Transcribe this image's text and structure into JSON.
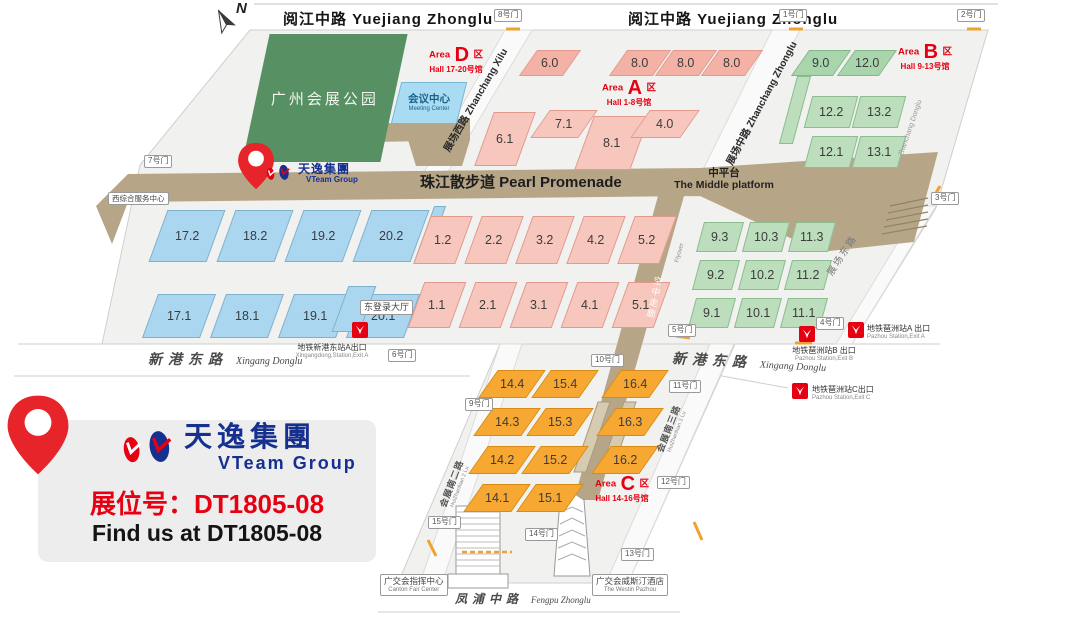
{
  "compass": {
    "n": "N"
  },
  "promo": {
    "booth_cn": "展位号：DT1805-08",
    "booth_en": "Find us at DT1805-08"
  },
  "logo": {
    "cn": "天逸集團",
    "en": "VTeam Group"
  },
  "roads": {
    "yuejiang": "阅江中路  Yuejiang Zhonglu",
    "promenade": "珠江散步道  Pearl Promenade",
    "middle_cn": "中平台",
    "middle_en": "The Middle platform",
    "xilu": "展场西路 Zhanchang Xilu",
    "zhonglu_v": "展场中路 Zhanchang Zhonglu",
    "donglu_cn": "展场东路",
    "donglu_en": "Zhanchang Donglu",
    "xingang_cn": "新港东路",
    "xingang_en": "Xingang Donglu",
    "fengpu_cn": "凤浦中路",
    "fengpu_en": "Fengpu Zhonglu",
    "hzn2_cn": "会展南二路",
    "hzn2_en": "HuiZhanNan 2 Lu",
    "hzn3_cn": "会展南三路",
    "hzn3_en": "HuiZhanNan 3 Lu",
    "sky_cn": "空中走廊",
    "sky_en": "Flyover"
  },
  "areas": {
    "a": {
      "prefix": "Area",
      "letter": "A",
      "qu": "区",
      "halls": "Hall 1-8号馆"
    },
    "b": {
      "prefix": "Area",
      "letter": "B",
      "qu": "区",
      "halls": "Hall 9-13号馆"
    },
    "c": {
      "prefix": "Area",
      "letter": "C",
      "qu": "区",
      "halls": "Hall 14-16号馆"
    },
    "d": {
      "prefix": "Area",
      "letter": "D",
      "qu": "区",
      "halls": "Hall 17-20号馆"
    }
  },
  "landmarks": {
    "park": "广州会展公园",
    "meeting_cn": "会议中心",
    "meeting_en": "Meeting Center",
    "west_service": "西综合服务中心",
    "east_hall": "东登录大厅",
    "canton_cn": "广交会指挥中心",
    "canton_en": "Canton Fair Center",
    "westin_cn": "广交会威斯汀酒店",
    "westin_en": "The Westin Pazhou"
  },
  "gates": {
    "g1": "1号门",
    "g2": "2号门",
    "g3": "3号门",
    "g4": "4号门",
    "g5": "5号门",
    "g6": "6号门",
    "g7": "7号门",
    "g8": "8号门",
    "g9": "9号门",
    "g10": "10号门",
    "g11": "11号门",
    "g12": "12号门",
    "g13": "13号门",
    "g14": "14号门",
    "g15": "15号门"
  },
  "metro": {
    "xingang_cn": "地铁新港东站A出口",
    "xingang_en": "Xingangdong,Station,Exit A",
    "pa_cn": "地铁琶洲站A 出口",
    "pa_en": "Pazhou Station,Exit A",
    "pb_cn": "地铁琶洲站B 出口",
    "pb_en": "Pazhou Station,Exit B",
    "pc_cn": "地铁琶洲站C出口",
    "pc_en": "Pazhou Station,Exit C"
  },
  "halls": {
    "blue": [
      "17.2",
      "18.2",
      "19.2",
      "20.2",
      "17.1",
      "18.1",
      "19.1",
      "20.1"
    ],
    "pink_top": [
      "6.0",
      "8.0",
      "8.0",
      "8.0"
    ],
    "pink_mid": [
      "6.1",
      "7.1",
      "8.1",
      "4.0"
    ],
    "pink_12": [
      "1.2",
      "2.2",
      "3.2",
      "4.2",
      "5.2"
    ],
    "pink_11": [
      "1.1",
      "2.1",
      "3.1",
      "4.1",
      "5.1"
    ],
    "green_top": [
      "9.0",
      "12.0"
    ],
    "green_b": [
      "12.2",
      "13.2",
      "12.1",
      "13.1"
    ],
    "green_right": [
      "9.3",
      "10.3",
      "11.3",
      "9.2",
      "10.2",
      "11.2",
      "9.1",
      "10.1",
      "11.1"
    ],
    "orange": [
      "14.4",
      "15.4",
      "16.4",
      "14.3",
      "15.3",
      "16.3",
      "14.2",
      "15.2",
      "16.2",
      "14.1",
      "15.1"
    ]
  },
  "colors": {
    "accent_red": "#e60012",
    "logo_blue": "#15308f",
    "promenade_tan": "#b6a687",
    "park_green": "#579063",
    "hall_blue": "#aad6f0",
    "hall_pink": "#f7c7bd",
    "hall_green": "#bcdebd",
    "hall_orange": "#f6a832"
  }
}
